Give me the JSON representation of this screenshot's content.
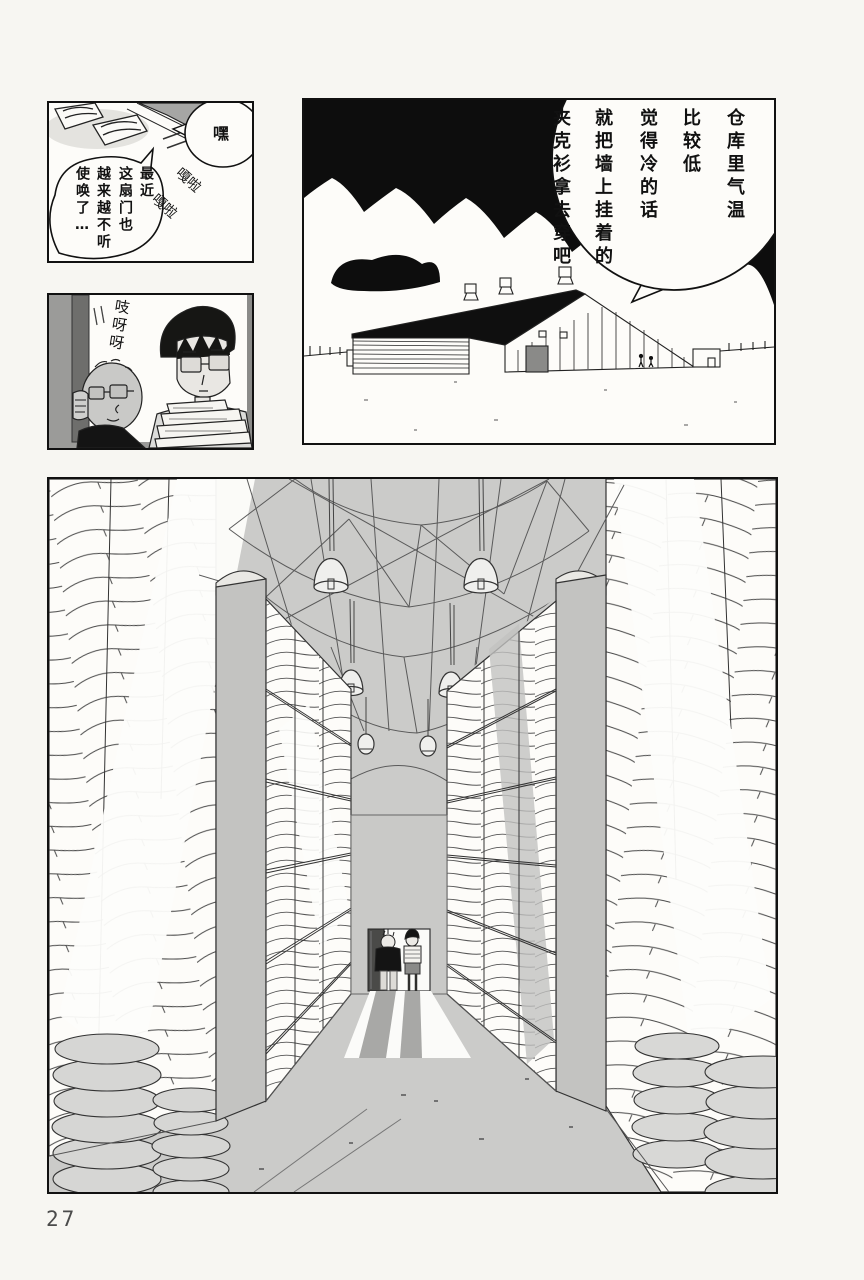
{
  "page": {
    "number": "27"
  },
  "colors": {
    "paper": "#f7f6f2",
    "ink": "#111111",
    "panel_gray": "#cbcbc9",
    "mid_gray": "#9b9b9b",
    "door_edge_gray": "#6e6e6c",
    "shadow_gray": "#a8a8a6"
  },
  "panel_door_slide": {
    "bubble_hey": "嘿",
    "bubble_complaint": {
      "lines": [
        "最近",
        "这扇门也",
        "越来越不听",
        "使唤了…"
      ]
    },
    "sfx_rattle": [
      "嘎啦",
      "嘎啦"
    ]
  },
  "panel_warehouse_exterior": {
    "bubble_jacket": {
      "lines": [
        "仓库里气温",
        "比较低",
        "觉得冷的话",
        "就把墙上挂着的",
        "夹克衫拿去穿吧"
      ]
    }
  },
  "panel_peeking": {
    "sfx_creak": "吱呀呀"
  }
}
